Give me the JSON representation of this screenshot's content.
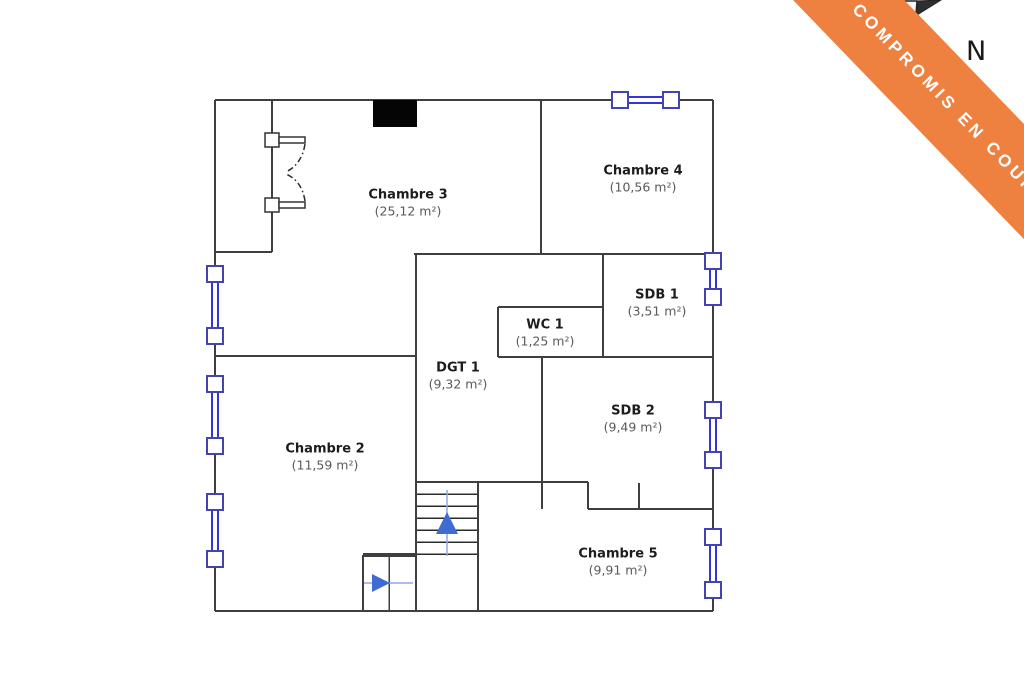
{
  "plan": {
    "rooms": [
      {
        "name": "Chambre 3",
        "area": "(25,12 m²)"
      },
      {
        "name": "Chambre 4",
        "area": "(10,56 m²)"
      },
      {
        "name": "SDB 1",
        "area": "(3,51 m²)"
      },
      {
        "name": "WC 1",
        "area": "(1,25 m²)"
      },
      {
        "name": "DGT 1",
        "area": "(9,32 m²)"
      },
      {
        "name": "SDB 2",
        "area": "(9,49 m²)"
      },
      {
        "name": "Chambre 2",
        "area": "(11,59 m²)"
      },
      {
        "name": "Chambre 5",
        "area": "(9,91 m²)"
      }
    ],
    "icons": {
      "window": "window-symbol",
      "double_door": "double-door-swing",
      "fireplace": "fireplace-block",
      "stairs_up_arrow": "up-arrow",
      "entry_arrow": "right-arrow",
      "compass_needle": "compass-needle"
    },
    "colors": {
      "wall_gray": "#3F3F3F",
      "window_blue": "#3535D6",
      "arrow_blue": "#3E6CD4",
      "banner_orange": "#EF8140"
    }
  },
  "banner": {
    "text": "COMPROMIS EN COURS"
  },
  "compass": {
    "label": "N"
  }
}
